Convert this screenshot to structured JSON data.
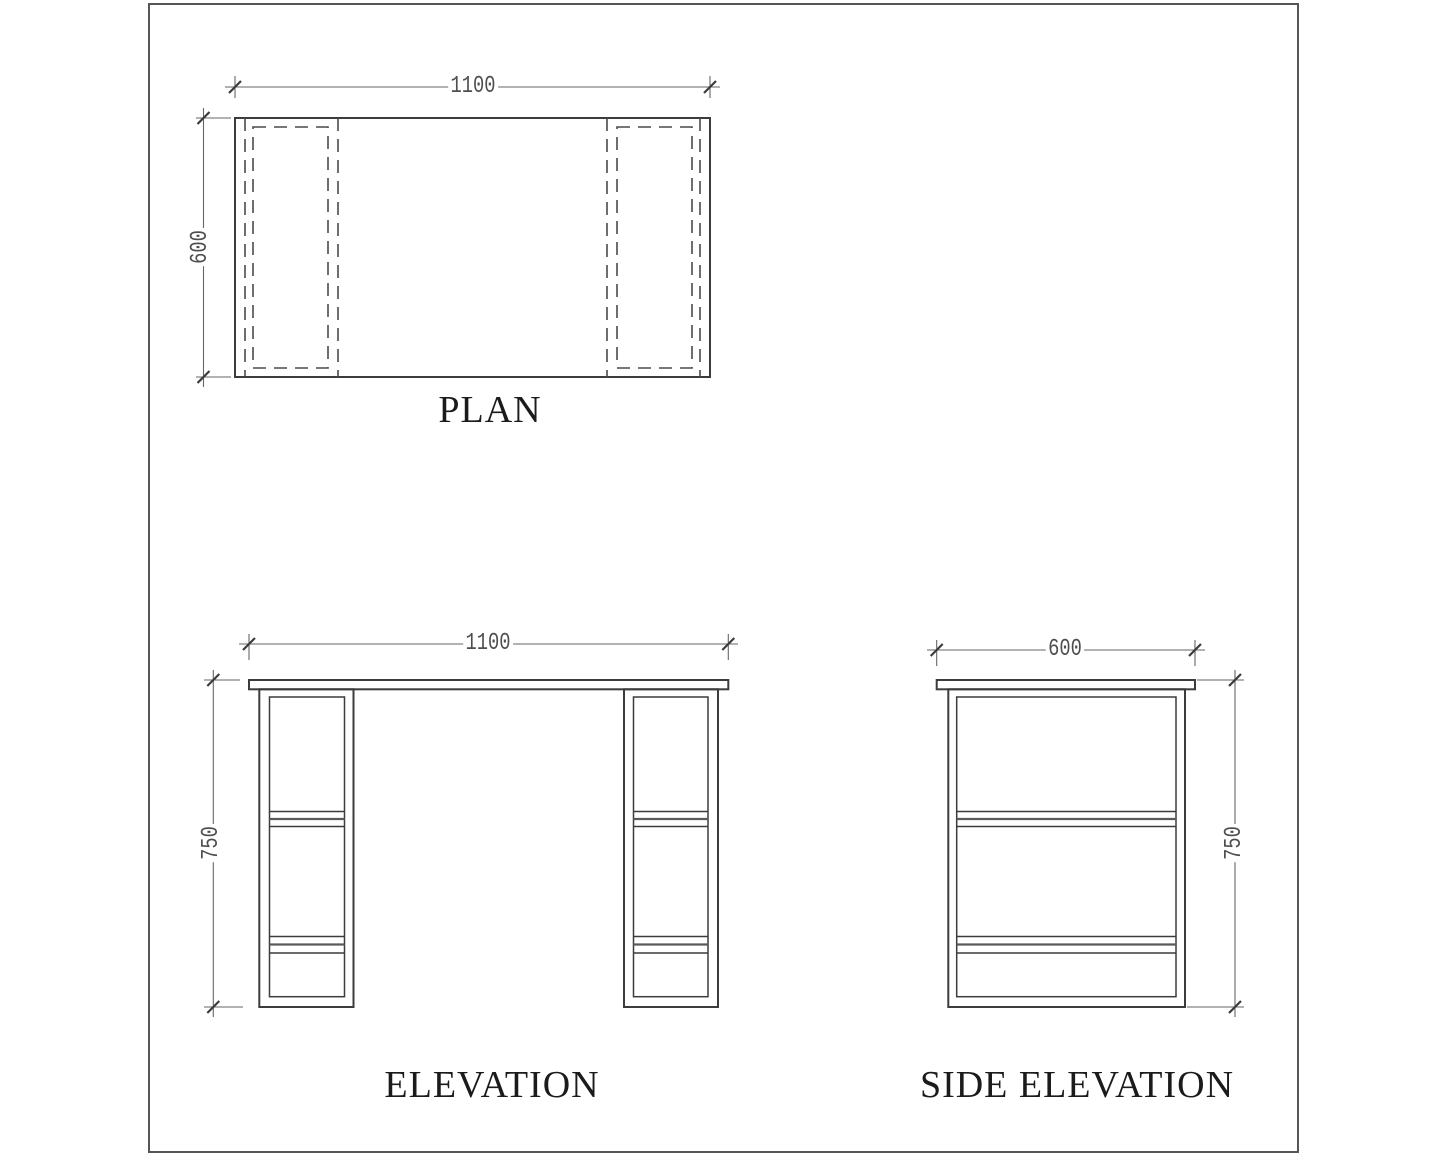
{
  "views": {
    "plan": {
      "title": "PLAN",
      "width_label": "1100",
      "depth_label": "600"
    },
    "elevation": {
      "title": "ELEVATION",
      "width_label": "1100",
      "height_label": "750"
    },
    "side_elevation": {
      "title": "SIDE ELEVATION",
      "depth_label": "600",
      "height_label": "750"
    }
  },
  "dimensions_mm": {
    "width": 1100,
    "depth": 600,
    "height": 750
  },
  "style": {
    "object_line_color": "#3c3c3c",
    "hidden_line_color": "#4a4a4a",
    "dimension_line_color": "#666666",
    "dimension_text_color": "#4e4e4e",
    "title_color": "#1b1b1b",
    "page_border_color": "#565656",
    "background": "#ffffff"
  }
}
